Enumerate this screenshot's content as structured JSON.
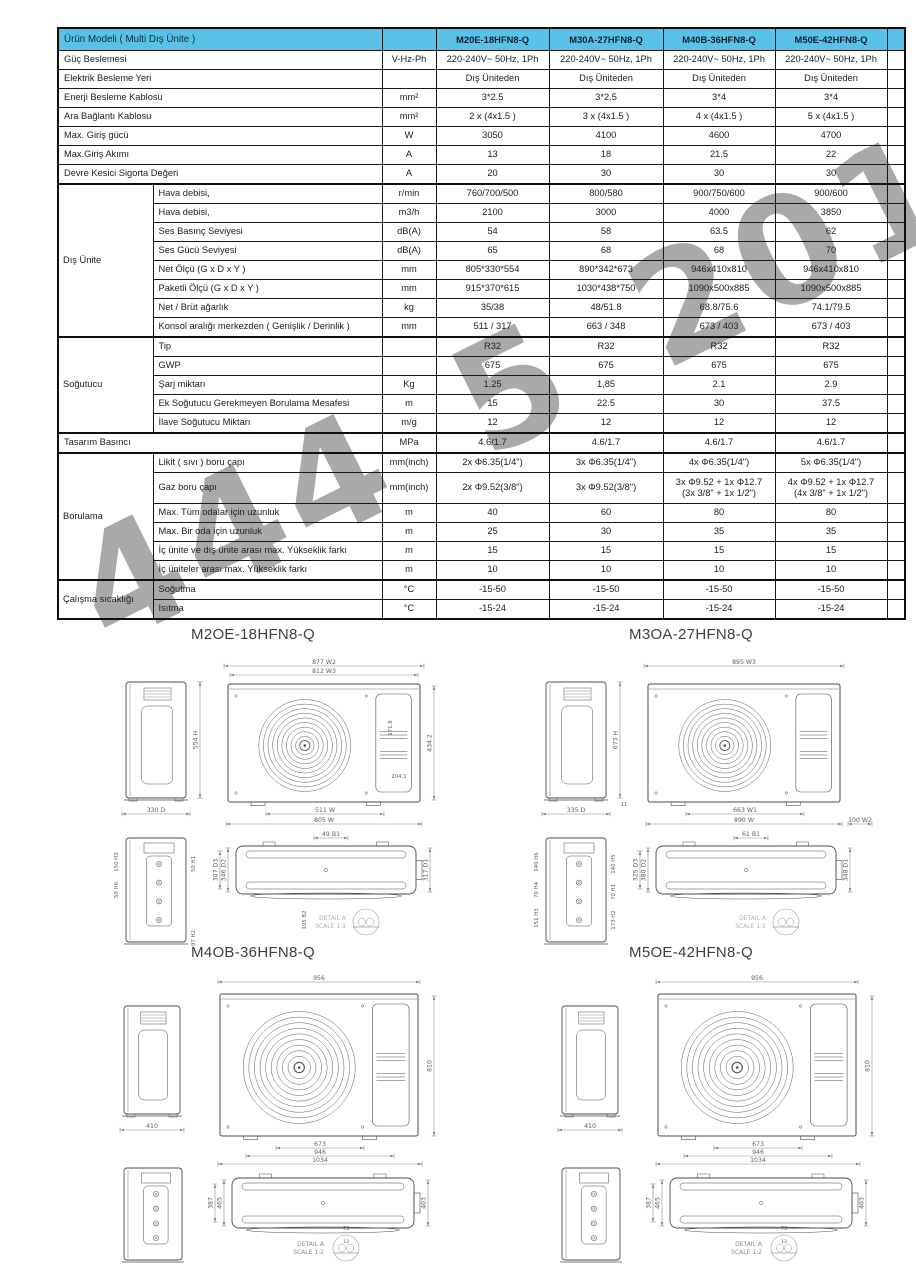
{
  "watermark_text": "444 5 201",
  "accent_color": "#5bc2e7",
  "table": {
    "header": {
      "label": "Ürün Modeli ( Multi Dış Ünite )",
      "models": [
        "M20E-18HFN8-Q",
        "M30A-27HFN8-Q",
        "M40B-36HFN8-Q",
        "M50E-42HFN8-Q"
      ]
    },
    "rows": [
      {
        "label": "Güç Beslemesi",
        "unit": "V-Hz-Ph",
        "values": [
          "220-240V~ 50Hz, 1Ph",
          "220-240V~ 50Hz, 1Ph",
          "220-240V~ 50Hz, 1Ph",
          "220-240V~ 50Hz, 1Ph"
        ]
      },
      {
        "label": "Elektrik Besleme Yeri",
        "unit": "",
        "values": [
          "Dış Üniteden",
          "Dış Üniteden",
          "Dış Üniteden",
          "Dış Üniteden"
        ]
      },
      {
        "label": "Enerji Besleme Kablosu",
        "unit": "mm²",
        "values": [
          "3*2.5",
          "3*2.5",
          "3*4",
          "3*4"
        ]
      },
      {
        "label": "Ara Bağlantı Kablosu",
        "unit": "mm²",
        "values": [
          "2 x (4x1.5 )",
          "3 x (4x1.5 )",
          "4 x (4x1.5 )",
          "5 x (4x1.5 )"
        ]
      },
      {
        "label": "Max. Giriş gücü",
        "unit": "W",
        "values": [
          "3050",
          "4100",
          "4600",
          "4700"
        ]
      },
      {
        "label": "Max.Giriş Akımı",
        "unit": "A",
        "values": [
          "13",
          "18",
          "21.5",
          "22"
        ]
      },
      {
        "label": "Devre Kesici Sigorta Değeri",
        "unit": "A",
        "values": [
          "20",
          "30",
          "30",
          "30"
        ]
      },
      {
        "group": "Dış Ünite",
        "span": 8,
        "label": "Hava debisi,",
        "unit": "r/min",
        "values": [
          "760/700/500",
          "800/580",
          "900/750/600",
          "900/600"
        ]
      },
      {
        "label": "Hava debisi,",
        "unit": "m3/h",
        "values": [
          "2100",
          "3000",
          "4000",
          "3850"
        ]
      },
      {
        "label": "Ses Basınç Seviyesi",
        "unit": "dB(A)",
        "values": [
          "54",
          "58",
          "63.5",
          "62"
        ]
      },
      {
        "label": "Ses Gücü Seviyesi",
        "unit": "dB(A)",
        "values": [
          "65",
          "68",
          "68",
          "70"
        ]
      },
      {
        "label": "Net Ölçü (G x D x Y )",
        "unit": "mm",
        "values": [
          "805*330*554",
          "890*342*673",
          "946x410x810",
          "946x410x810"
        ]
      },
      {
        "label": "Paketli Ölçü (G x D x Y )",
        "unit": "mm",
        "values": [
          "915*370*615",
          "1030*438*750",
          "1090x500x885",
          "1090x500x885"
        ]
      },
      {
        "label": "Net / Brüt ağarlık",
        "unit": "kg",
        "values": [
          "35/38",
          "48/51.8",
          "68.8/75.6",
          "74.1/79.5"
        ]
      },
      {
        "label": "Konsol aralığı merkezden ( Genişlik / Derinlik )",
        "unit": "mm",
        "values": [
          "511 / 317",
          "663 / 348",
          "673 / 403",
          "673 / 403"
        ]
      },
      {
        "group": "Soğutucu",
        "span": 5,
        "label": "Tip",
        "unit": "",
        "values": [
          "R32",
          "R32",
          "R32",
          "R32"
        ]
      },
      {
        "label": "GWP",
        "unit": "",
        "values": [
          "675",
          "675",
          "675",
          "675"
        ]
      },
      {
        "label": "Şarj miktarı",
        "unit": "Kg",
        "values": [
          "1.25",
          "1,85",
          "2.1",
          "2.9"
        ]
      },
      {
        "label": "Ek Soğutucu Gerekmeyen Borulama Mesafesi",
        "unit": "m",
        "values": [
          "15",
          "22.5",
          "30",
          "37.5"
        ]
      },
      {
        "label": "İlave Soğutucu Miktarı",
        "unit": "m/g",
        "values": [
          "12",
          "12",
          "12",
          "12"
        ]
      },
      {
        "full": true,
        "label": "Tasarım Basıncı",
        "unit": "MPa",
        "values": [
          "4.6/1.7",
          "4.6/1.7",
          "4.6/1.7",
          "4.6/1.7"
        ]
      },
      {
        "group": "Borulama",
        "span": 6,
        "label": "Likit ( sıvı ) boru çapı",
        "unit": "mm(inch)",
        "values": [
          "2x Φ6.35(1/4\")",
          "3x Φ6.35(1/4\")",
          "4x Φ6.35(1/4\")",
          "5x Φ6.35(1/4\")"
        ]
      },
      {
        "label": "Gaz boru çapı",
        "unit": "mm(inch)",
        "values": [
          "2x Φ9.52(3/8\")",
          "3x Φ9.52(3/8\")",
          "3x Φ9.52 + 1x Φ12.7\n(3x 3/8\" + 1x 1/2\")",
          "4x Φ9.52 + 1x Φ12.7\n(4x 3/8\" + 1x 1/2\")"
        ]
      },
      {
        "label": "Max. Tüm odalar için uzunluk",
        "unit": "m",
        "values": [
          "40",
          "60",
          "80",
          "80"
        ]
      },
      {
        "label": "Max. Bir oda için uzunluk",
        "unit": "m",
        "values": [
          "25",
          "30",
          "35",
          "35"
        ]
      },
      {
        "label": "İç ünite ve dış ünite arası max. Yükseklik farkı",
        "unit": "m",
        "values": [
          "15",
          "15",
          "15",
          "15"
        ]
      },
      {
        "label": "İç üniteler arası max. Yükseklik farkı",
        "unit": "m",
        "values": [
          "10",
          "10",
          "10",
          "10"
        ]
      },
      {
        "group": "Çalışma sıcaklığı",
        "span": 2,
        "label": "Soğutma",
        "unit": "°C",
        "values": [
          "-15-50",
          "-15-50",
          "-15-50",
          "-15-50"
        ]
      },
      {
        "label": "Isıtma",
        "unit": "°C",
        "values": [
          "-15-24",
          "-15-24",
          "-15-24",
          "-15-24"
        ]
      }
    ]
  },
  "drawings": [
    {
      "title": "M2OE-18HFN8-Q",
      "layout": "A",
      "side": {
        "h": "554 H",
        "d": "330 D"
      },
      "front": {
        "top": [
          "877 W2",
          "812 W3"
        ],
        "bottom": [
          "511 W",
          "805 W"
        ],
        "right": [
          "434.2"
        ],
        "inner": [
          "171.8",
          "204.1"
        ]
      },
      "back": {
        "left": [
          "150 H3",
          "50 H6"
        ],
        "right": [
          "50 H1"
        ],
        "bottom": [
          "97 H2"
        ]
      },
      "top_view": {
        "top": [
          "49 B1"
        ],
        "left": [
          "346 D2",
          "307 D3"
        ],
        "right": [
          "317 D1"
        ],
        "extra": [
          "105 B2"
        ]
      },
      "detail": {
        "label": "DETAIL A",
        "scale": "SCALE 1:1",
        "dims": []
      }
    },
    {
      "title": "M3OA-27HFN8-Q",
      "layout": "A",
      "side": {
        "h": "673 H",
        "d": "335 D",
        "extra": "11"
      },
      "front": {
        "top": [
          "895 W3"
        ],
        "bottom": [
          "663 W1",
          "890 W",
          "100 W2"
        ],
        "right": [],
        "inner": []
      },
      "back": {
        "left": [
          "140 H6",
          "70 H4",
          "151 H3"
        ],
        "right": [
          "140 H5",
          "70 H1",
          "173 H2"
        ],
        "bottom": []
      },
      "top_view": {
        "top": [
          "61 B1"
        ],
        "left": [
          "380 D2",
          "325 D3"
        ],
        "right": [
          "348 D1"
        ],
        "extra": []
      },
      "detail": {
        "label": "DETAIL A",
        "scale": "SCALE 1:1",
        "dims": []
      }
    },
    {
      "title": "M4OB-36HFN8-Q",
      "layout": "C",
      "side": {
        "d": "410"
      },
      "front": {
        "top": [
          "956"
        ],
        "bottom": [
          "673",
          "946",
          "1034"
        ],
        "right": [
          "810"
        ],
        "inner": []
      },
      "back": {
        "left": [],
        "right": [],
        "bottom": []
      },
      "top_view": {
        "top": [],
        "left": [
          "465",
          "387"
        ],
        "right": [
          "403"
        ],
        "extra": []
      },
      "detail": {
        "label": "DETAIL A",
        "scale": "SCALE 1:2",
        "dims": [
          "73",
          "13"
        ]
      }
    },
    {
      "title": "M5OE-42HFN8-Q",
      "layout": "C",
      "side": {
        "d": "410"
      },
      "front": {
        "top": [
          "956"
        ],
        "bottom": [
          "673",
          "946",
          "1034"
        ],
        "right": [
          "810"
        ],
        "inner": []
      },
      "back": {
        "left": [],
        "right": [],
        "bottom": []
      },
      "top_view": {
        "top": [],
        "left": [
          "465",
          "387"
        ],
        "right": [
          "403"
        ],
        "extra": []
      },
      "detail": {
        "label": "DETAIL A",
        "scale": "SCALE 1:2",
        "dims": [
          "73",
          "13"
        ]
      }
    }
  ]
}
